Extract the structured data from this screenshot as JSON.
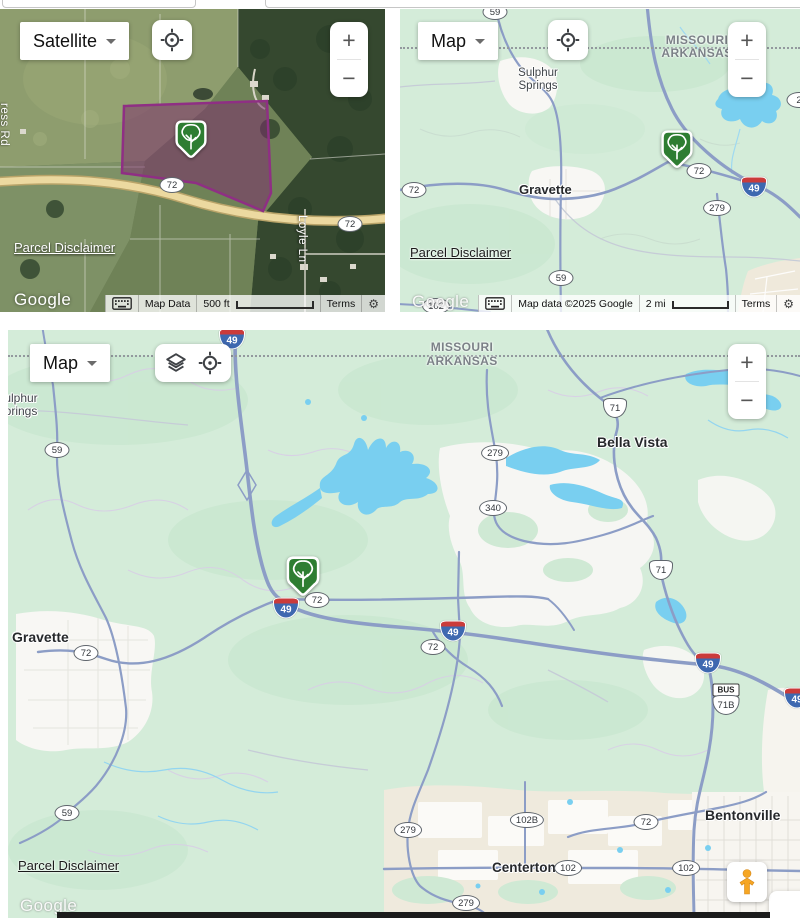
{
  "panel_satellite": {
    "map_type": "Satellite",
    "shields": [
      "72",
      "72"
    ],
    "street_labels": {
      "loyle": "Loyle Ln",
      "ress": "ress Rd"
    },
    "parcel_disclaimer": "Parcel Disclaimer",
    "google": "Google",
    "bar": {
      "map_data": "Map Data",
      "scale": "500 ft",
      "terms": "Terms"
    },
    "zoom_in": "+",
    "zoom_out": "−"
  },
  "panel_regional": {
    "map_type": "Map",
    "state_north": "MISSOURI",
    "state_south": "ARKANSAS",
    "towns": {
      "sulphur_1": "Sulphur",
      "sulphur_2": "Springs",
      "gravette": "Gravette"
    },
    "oval_shields": [
      "59",
      "72",
      "72",
      "279",
      "59",
      "102",
      "2"
    ],
    "interstate": "49",
    "parcel_disclaimer": "Parcel Disclaimer",
    "google": "Google",
    "bar": {
      "attribution": "Map data ©2025 Google",
      "scale": "2 mi",
      "terms": "Terms"
    },
    "zoom_in": "+",
    "zoom_out": "−"
  },
  "panel_overview": {
    "map_type": "Map",
    "state_north": "MISSOURI",
    "state_south": "ARKANSAS",
    "towns": {
      "sulphur_1": "Sulphur",
      "sulphur_2": "Springs",
      "gravette": "Gravette",
      "bella_vista": "Bella Vista",
      "centerton": "Centerton",
      "bentonville": "Bentonville"
    },
    "oval_shields": [
      "59",
      "279",
      "340",
      "72",
      "72",
      "72",
      "59",
      "279",
      "279",
      "102B",
      "102",
      "102",
      "72"
    ],
    "us_shields": [
      "71",
      "71",
      "71B"
    ],
    "bus_label": "BUS",
    "interstates": [
      "49",
      "49",
      "49",
      "49",
      "49"
    ],
    "parcel_disclaimer": "Parcel Disclaimer",
    "google": "Google",
    "zoom_in": "+",
    "zoom_out": "−"
  },
  "colors": {
    "marker_green": "#2e7d32",
    "parcel_purple": "#8f2f84",
    "land_green": "#d4ecd9",
    "water_blue": "#79cff0",
    "road_blue_gray": "#8c9dc6",
    "interstate_blue": "#3e68b0",
    "interstate_red": "#ca3b3b"
  }
}
